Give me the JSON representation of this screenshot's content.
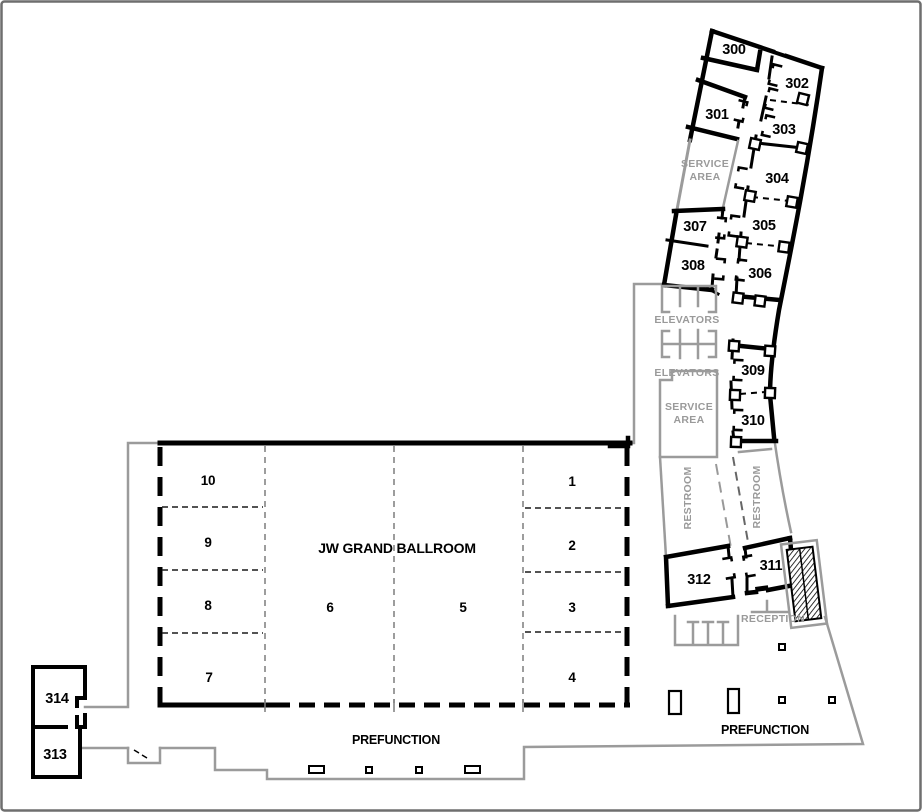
{
  "floorplan": {
    "ballroom": {
      "title": "JW GRAND BALLROOM",
      "sections": {
        "s1": "1",
        "s2": "2",
        "s3": "3",
        "s4": "4",
        "s5": "5",
        "s6": "6",
        "s7": "7",
        "s8": "8",
        "s9": "9",
        "s10": "10"
      }
    },
    "rooms": {
      "r300": "300",
      "r301": "301",
      "r302": "302",
      "r303": "303",
      "r304": "304",
      "r305": "305",
      "r306": "306",
      "r307": "307",
      "r308": "308",
      "r309": "309",
      "r310": "310",
      "r311": "311",
      "r312": "312",
      "r313": "313",
      "r314": "314"
    },
    "areas": {
      "service_word1": "SERVICE",
      "service_word2": "AREA",
      "elevators": "ELEVATORS",
      "restroom": "RESTROOM",
      "reception": "RECEPTION",
      "prefunction": "PREFUNCTION"
    },
    "colors": {
      "wall": "#000000",
      "boundary": "#9b9b9b",
      "muted_text": "#9a9a9a",
      "text": "#000000",
      "background": "#ffffff"
    }
  }
}
